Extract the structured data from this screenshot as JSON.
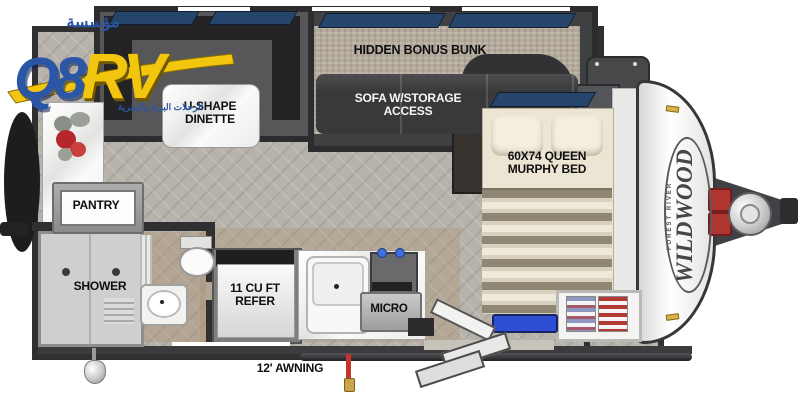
{
  "logo": {
    "arabic_top": "مؤسسة",
    "brand_q8": "Q8",
    "brand_rv": "RV",
    "arabic_tagline": "الرحلات البرية والبحرية"
  },
  "floorplan": {
    "labels": {
      "hidden_bonus_bunk": "HIDDEN BONUS BUNK",
      "sofa_storage": "SOFA W/STORAGE ACCESS",
      "u_shape_dinette": "U-SHAPE DINETTE",
      "queen_murphy_bed": "60X74 QUEEN MURPHY BED",
      "pantry": "PANTRY",
      "shower": "SHOWER",
      "refer": "11 CU FT REFER",
      "micro": "MICRO",
      "awning": "12' AWNING"
    },
    "exterior_brand": {
      "name": "WILDWOOD",
      "sub": "FOREST RIVER"
    }
  },
  "colors": {
    "logo_blue": "#2b55a5",
    "logo_yellow": "#f2c50e",
    "wall_dark": "#303032",
    "floor_gray": "#b7b3ab",
    "window_blue": "#26456b",
    "bed_cream": "#ece5d3",
    "accent_red": "#b03430",
    "mat_blue": "#2e4fd4"
  }
}
